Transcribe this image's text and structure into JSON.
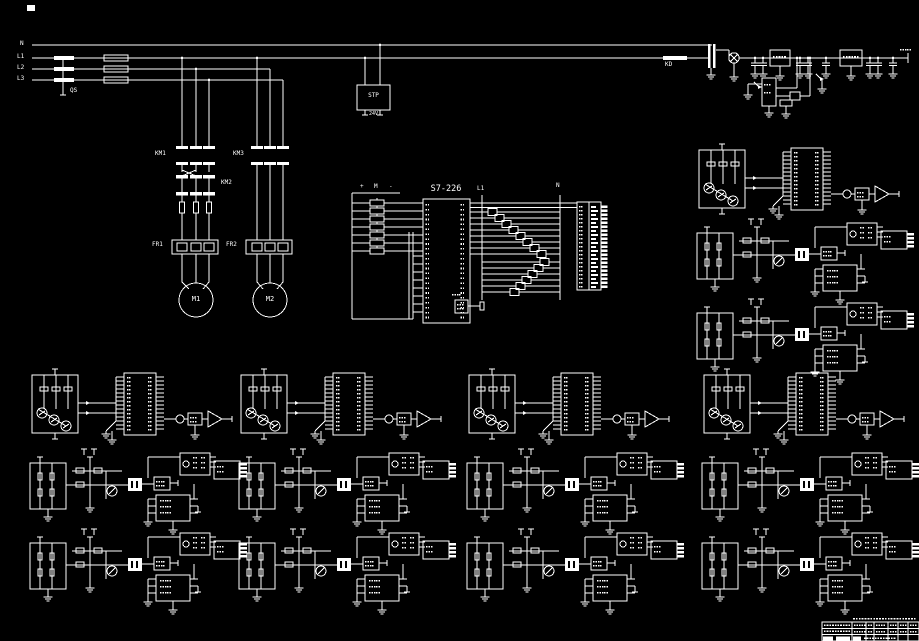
{
  "canvas": {
    "width": 919,
    "height": 641,
    "bg": "#000000",
    "fg": "#ffffff"
  },
  "power": {
    "rails": [
      {
        "label": "N"
      },
      {
        "label": "L1"
      },
      {
        "label": "L2"
      },
      {
        "label": "L3"
      }
    ],
    "switch_label": "QS",
    "line_fuse_label": "KD"
  },
  "psu": {
    "box_label": "STP",
    "box_sublabel": "24V"
  },
  "branch1": {
    "contactor_upper": "KM1",
    "contactor_lower": "KM2",
    "overload": "FR1",
    "motor": "M1"
  },
  "branch2": {
    "contactor": "KM3",
    "overload": "FR2",
    "motor": "M2"
  },
  "plc": {
    "label": "S7-226",
    "left_rail": "L1",
    "right_rail": "N",
    "button_bus": {
      "plus": "+",
      "mid": "M",
      "minus": "-"
    }
  },
  "layout": {
    "rail_ys": [
      45,
      58,
      69,
      80
    ],
    "module_groups": [
      {
        "x": 28,
        "rows": [
          365,
          447,
          527
        ]
      },
      {
        "x": 237,
        "rows": [
          365,
          447,
          527
        ]
      },
      {
        "x": 465,
        "rows": [
          365,
          447,
          527
        ]
      },
      {
        "x": 700,
        "rows": [
          365,
          447,
          527
        ]
      },
      {
        "x": 695,
        "rows": [
          140,
          217,
          297
        ]
      }
    ]
  }
}
